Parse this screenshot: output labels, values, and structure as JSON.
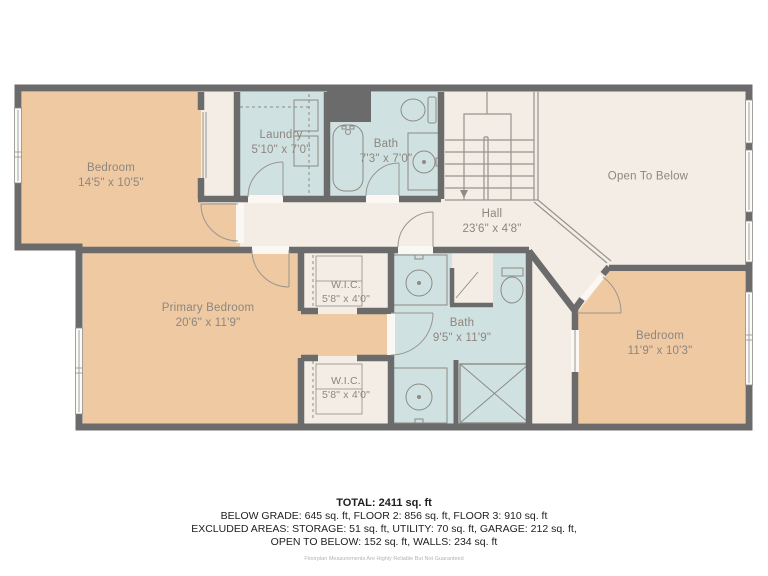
{
  "palette": {
    "wall": "#6b6b6b",
    "room_tan": "#eec9a2",
    "room_blue": "#cfe2e1",
    "floor_cream": "#f4ede5",
    "threshold_white": "#fbf8f4",
    "fixture_line": "#8f8a84",
    "label_text": "#8d8680",
    "summary_text": "#1e1e1e",
    "disclaimer_text": "#b7b3ae"
  },
  "rooms": [
    {
      "id": "bedroom-top-left",
      "name": "Bedroom",
      "dims": "14'5\" x 10'5\""
    },
    {
      "id": "laundry",
      "name": "Laundry",
      "dims": "5'10\" x 7'0\""
    },
    {
      "id": "bath-top",
      "name": "Bath",
      "dims": "7'3\" x 7'0\""
    },
    {
      "id": "open-to-below",
      "name": "Open To Below",
      "dims": ""
    },
    {
      "id": "hall",
      "name": "Hall",
      "dims": "23'6\" x 4'8\""
    },
    {
      "id": "wic-top",
      "name": "W.I.C.",
      "dims": "5'8\" x 4'0\""
    },
    {
      "id": "primary-bedroom",
      "name": "Primary Bedroom",
      "dims": "20'6\" x 11'9\""
    },
    {
      "id": "bath-bottom",
      "name": "Bath",
      "dims": "9'5\" x 11'9\""
    },
    {
      "id": "wic-bottom",
      "name": "W.I.C.",
      "dims": "5'8\" x 4'0\""
    },
    {
      "id": "bedroom-right",
      "name": "Bedroom",
      "dims": "11'9\" x 10'3\""
    }
  ],
  "summary": {
    "total": "TOTAL: 2411 sq. ft",
    "line1": "BELOW GRADE: 645 sq. ft, FLOOR 2: 856 sq. ft, FLOOR 3: 910 sq. ft",
    "line2": "EXCLUDED AREAS: STORAGE: 51 sq. ft, UTILITY: 70 sq. ft, GARAGE: 212 sq. ft,",
    "line3": "OPEN TO BELOW: 152 sq. ft, WALLS: 234 sq. ft",
    "disclaimer": "Floorplan Measurements Are Highly Reliable But Not Guaranteed"
  }
}
